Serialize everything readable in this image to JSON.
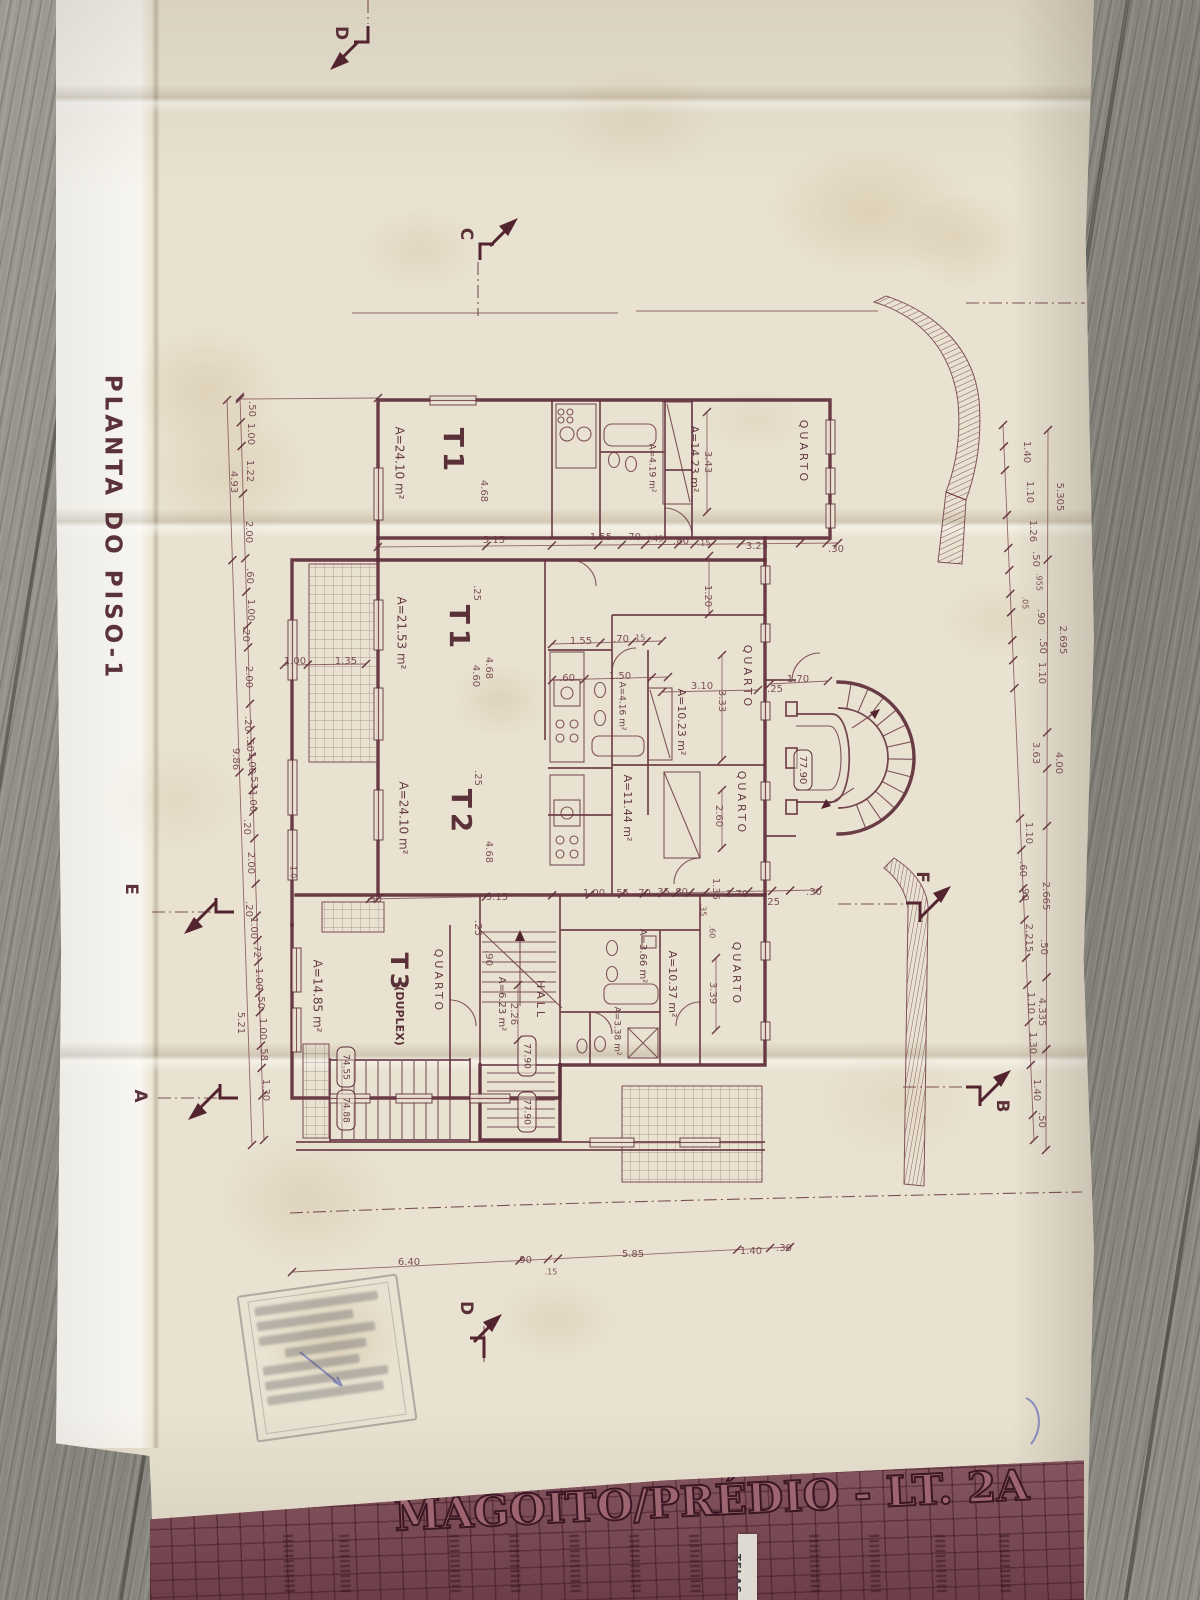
{
  "drawing": {
    "title": "PLANTA DO PISO-1",
    "title_block": {
      "project": "MAGOITO/PRÉDIO - LT. 2A",
      "tape_label": "TELAS"
    },
    "units": [
      {
        "code": "T1",
        "area": "A=24.10 m²"
      },
      {
        "code": "T1",
        "area": "A=21.53 m²"
      },
      {
        "code": "T2",
        "area": "A=24.10 m²"
      },
      {
        "code": "T3 (DUPLEX)",
        "area": "A=14.85 m²"
      }
    ],
    "room_names": [
      "QUARTO",
      "HALL"
    ],
    "levels": [
      "77.90",
      "74.55",
      "74.88"
    ],
    "section_markers": [
      "A",
      "B",
      "C",
      "D",
      "E",
      "F"
    ],
    "labels": [
      {
        "t": "PLANTA DO PISO-1",
        "x": 112,
        "y": 528,
        "r": 1,
        "s": 23,
        "k": "title",
        "ls": 4
      },
      {
        "t": "D",
        "x": 341,
        "y": 33,
        "r": 1,
        "s": 17,
        "k": "section"
      },
      {
        "t": "C",
        "x": 466,
        "y": 234,
        "r": 1,
        "s": 17,
        "k": "section"
      },
      {
        "t": "E",
        "x": 131,
        "y": 889,
        "r": 1,
        "s": 17,
        "k": "section"
      },
      {
        "t": "A",
        "x": 140,
        "y": 1096,
        "r": 1,
        "s": 17,
        "k": "section"
      },
      {
        "t": "F",
        "x": 922,
        "y": 877,
        "r": 1,
        "s": 17,
        "k": "section"
      },
      {
        "t": "B",
        "x": 1002,
        "y": 1106,
        "r": 1,
        "s": 17,
        "k": "section"
      },
      {
        "t": "D",
        "x": 466,
        "y": 1308,
        "r": 1,
        "s": 17,
        "k": "section"
      },
      {
        "t": "T1",
        "x": 452,
        "y": 452,
        "r": 1,
        "s": 28,
        "k": "unit",
        "ls": 5
      },
      {
        "t": "A=24.10 m²",
        "x": 399,
        "y": 463,
        "r": 1,
        "s": 12,
        "k": "area"
      },
      {
        "t": "T1",
        "x": 458,
        "y": 629,
        "r": 1,
        "s": 28,
        "k": "unit",
        "ls": 5
      },
      {
        "t": "A=21.53 m²",
        "x": 401,
        "y": 633,
        "r": 1,
        "s": 12,
        "k": "area"
      },
      {
        "t": "T2",
        "x": 460,
        "y": 813,
        "r": 1,
        "s": 28,
        "k": "unit",
        "ls": 5
      },
      {
        "t": "A=24.10 m²",
        "x": 403,
        "y": 818,
        "r": 1,
        "s": 12,
        "k": "area"
      },
      {
        "t": "T3",
        "x": 398,
        "y": 973,
        "r": 1,
        "s": 24,
        "k": "unit",
        "ls": 4
      },
      {
        "t": "(DUPLEX)",
        "x": 399,
        "y": 1016,
        "r": 1,
        "s": 11,
        "k": "unit"
      },
      {
        "t": "A=14.85 m²",
        "x": 317,
        "y": 996,
        "r": 1,
        "s": 12,
        "k": "area"
      },
      {
        "t": "QUARTO",
        "x": 803,
        "y": 452,
        "r": 1,
        "s": 11,
        "k": "room",
        "ls": 3
      },
      {
        "t": "A=14.23 m²",
        "x": 694,
        "y": 459,
        "r": 1,
        "s": 11,
        "k": "area"
      },
      {
        "t": "A=4.19 m²",
        "x": 652,
        "y": 468,
        "r": 1,
        "s": 9,
        "k": "area"
      },
      {
        "t": "QUARTO",
        "x": 747,
        "y": 677,
        "r": 1,
        "s": 11,
        "k": "room",
        "ls": 3
      },
      {
        "t": "A=10.23 m²",
        "x": 681,
        "y": 722,
        "r": 1,
        "s": 11,
        "k": "area"
      },
      {
        "t": "A=4.16 m²",
        "x": 622,
        "y": 706,
        "r": 1,
        "s": 9,
        "k": "area"
      },
      {
        "t": "QUARTO",
        "x": 741,
        "y": 803,
        "r": 1,
        "s": 11,
        "k": "room",
        "ls": 3
      },
      {
        "t": "A=11.44 m²",
        "x": 627,
        "y": 808,
        "r": 1,
        "s": 11,
        "k": "area"
      },
      {
        "t": "QUARTO",
        "x": 438,
        "y": 981,
        "r": 1,
        "s": 11,
        "k": "room",
        "ls": 3
      },
      {
        "t": "A=6.23 m²",
        "x": 502,
        "y": 1004,
        "r": 1,
        "s": 10,
        "k": "area"
      },
      {
        "t": "HALL",
        "x": 540,
        "y": 1000,
        "r": 1,
        "s": 11,
        "k": "room",
        "ls": 3
      },
      {
        "t": "A=3.66 m²",
        "x": 643,
        "y": 956,
        "r": 1,
        "s": 10,
        "k": "area"
      },
      {
        "t": "A=10.37 m²",
        "x": 672,
        "y": 984,
        "r": 1,
        "s": 11,
        "k": "area"
      },
      {
        "t": "QUARTO",
        "x": 736,
        "y": 974,
        "r": 1,
        "s": 11,
        "k": "room",
        "ls": 3
      },
      {
        "t": "A=3.38 m²",
        "x": 617,
        "y": 1031,
        "r": 1,
        "s": 9,
        "k": "area"
      },
      {
        "t": "77.90",
        "x": 803,
        "y": 770,
        "r": 1,
        "s": 10,
        "k": "level"
      },
      {
        "t": "77.90",
        "x": 527,
        "y": 1056,
        "r": 1,
        "s": 9,
        "k": "level"
      },
      {
        "t": "77.90",
        "x": 527,
        "y": 1112,
        "r": 1,
        "s": 9,
        "k": "level"
      },
      {
        "t": "74.55",
        "x": 346,
        "y": 1067,
        "r": 1,
        "s": 9,
        "k": "level"
      },
      {
        "t": "74.88",
        "x": 346,
        "y": 1110,
        "r": 1,
        "s": 9,
        "k": "level"
      },
      {
        "t": "5.15",
        "x": 494,
        "y": 540
      },
      {
        "t": "1.55",
        "x": 601,
        "y": 537
      },
      {
        "t": ".70",
        "x": 633,
        "y": 537
      },
      {
        "t": "(.45)",
        "x": 657,
        "y": 539,
        "s": 8
      },
      {
        "t": ".80",
        "x": 681,
        "y": 541
      },
      {
        "t": ".15",
        "x": 704,
        "y": 543,
        "s": 8
      },
      {
        "t": "3.25",
        "x": 757,
        "y": 546
      },
      {
        "t": ".30",
        "x": 836,
        "y": 549
      },
      {
        "t": "1.55",
        "x": 581,
        "y": 641
      },
      {
        "t": ".70",
        "x": 621,
        "y": 639
      },
      {
        "t": ".15",
        "x": 639,
        "y": 638,
        "s": 8
      },
      {
        "t": ".60",
        "x": 567,
        "y": 678
      },
      {
        "t": "1.50",
        "x": 620,
        "y": 676
      },
      {
        "t": "3.10",
        "x": 702,
        "y": 686
      },
      {
        "t": ".25",
        "x": 775,
        "y": 689
      },
      {
        "t": "1.70",
        "x": 798,
        "y": 679
      },
      {
        "t": "1.00",
        "x": 295,
        "y": 661
      },
      {
        "t": "1.35",
        "x": 346,
        "y": 661
      },
      {
        "t": ".30",
        "x": 374,
        "y": 899
      },
      {
        "t": "5.15",
        "x": 497,
        "y": 897
      },
      {
        "t": "1.00",
        "x": 594,
        "y": 893
      },
      {
        "t": ".55",
        "x": 621,
        "y": 893
      },
      {
        "t": ".70",
        "x": 643,
        "y": 893
      },
      {
        "t": ".35",
        "x": 662,
        "y": 892
      },
      {
        "t": ".80",
        "x": 680,
        "y": 892
      },
      {
        "t": "1.70",
        "x": 737,
        "y": 894
      },
      {
        "t": ".25",
        "x": 772,
        "y": 902
      },
      {
        "t": ".30",
        "x": 814,
        "y": 892
      },
      {
        "t": "6.40",
        "x": 409,
        "y": 1262
      },
      {
        "t": ".90",
        "x": 524,
        "y": 1260
      },
      {
        "t": ".15",
        "x": 551,
        "y": 1272,
        "s": 8
      },
      {
        "t": "5.85",
        "x": 633,
        "y": 1254
      },
      {
        "t": "1.40",
        "x": 751,
        "y": 1251
      },
      {
        "t": ".30",
        "x": 784,
        "y": 1248
      },
      {
        "t": "4.68",
        "x": 484,
        "y": 491,
        "r": 1
      },
      {
        "t": "3.43",
        "x": 708,
        "y": 462,
        "r": 1
      },
      {
        "t": "1.20",
        "x": 708,
        "y": 596,
        "r": 1
      },
      {
        "t": "4.68",
        "x": 489,
        "y": 668,
        "r": 1
      },
      {
        "t": "4.60",
        "x": 476,
        "y": 676,
        "r": 1
      },
      {
        "t": "3.33",
        "x": 722,
        "y": 701,
        "r": 1
      },
      {
        "t": "2.60",
        "x": 719,
        "y": 816,
        "r": 1
      },
      {
        "t": "4.68",
        "x": 489,
        "y": 852,
        "r": 1
      },
      {
        "t": ".25",
        "x": 477,
        "y": 593,
        "r": 1
      },
      {
        "t": ".25",
        "x": 478,
        "y": 778,
        "r": 1
      },
      {
        "t": "1.35",
        "x": 716,
        "y": 889,
        "r": 1
      },
      {
        "t": ".25",
        "x": 478,
        "y": 928,
        "r": 1
      },
      {
        "t": ".90",
        "x": 489,
        "y": 958,
        "r": 1
      },
      {
        "t": ".35",
        "x": 703,
        "y": 910,
        "r": 1,
        "s": 8
      },
      {
        "t": ".60",
        "x": 712,
        "y": 932,
        "r": 1,
        "s": 8
      },
      {
        "t": "3.39",
        "x": 713,
        "y": 993,
        "r": 1
      },
      {
        "t": "2.26",
        "x": 514,
        "y": 1014,
        "r": 1
      },
      {
        "t": "1.0",
        "x": 293,
        "y": 872,
        "r": 1,
        "s": 8
      },
      {
        "t": ".50",
        "x": 252,
        "y": 409,
        "r": 1
      },
      {
        "t": "1.00",
        "x": 251,
        "y": 434,
        "r": 1
      },
      {
        "t": "1.22",
        "x": 250,
        "y": 471,
        "r": 1
      },
      {
        "t": "4.93",
        "x": 234,
        "y": 482,
        "r": 1
      },
      {
        "t": "2.00",
        "x": 249,
        "y": 532,
        "r": 1
      },
      {
        "t": ".60",
        "x": 250,
        "y": 576,
        "r": 1
      },
      {
        "t": "1.00",
        "x": 251,
        "y": 610,
        "r": 1
      },
      {
        "t": ".20",
        "x": 246,
        "y": 634,
        "r": 1
      },
      {
        "t": "2.00",
        "x": 249,
        "y": 677,
        "r": 1
      },
      {
        "t": ".20",
        "x": 248,
        "y": 724,
        "r": 1
      },
      {
        "t": ".50",
        "x": 250,
        "y": 744,
        "r": 1
      },
      {
        "t": "1.00",
        "x": 252,
        "y": 763,
        "r": 1
      },
      {
        "t": ".53",
        "x": 254,
        "y": 781,
        "r": 1
      },
      {
        "t": "9.86",
        "x": 236,
        "y": 759,
        "r": 1
      },
      {
        "t": "1.00",
        "x": 253,
        "y": 801,
        "r": 1
      },
      {
        "t": ".20",
        "x": 247,
        "y": 827,
        "r": 1
      },
      {
        "t": "2.00",
        "x": 251,
        "y": 863,
        "r": 1
      },
      {
        "t": ".20",
        "x": 249,
        "y": 909,
        "r": 1
      },
      {
        "t": "1.00",
        "x": 254,
        "y": 928,
        "r": 1
      },
      {
        "t": ".72",
        "x": 257,
        "y": 950,
        "r": 1
      },
      {
        "t": "1.00",
        "x": 259,
        "y": 979,
        "r": 1
      },
      {
        "t": ".50",
        "x": 261,
        "y": 1001,
        "r": 1
      },
      {
        "t": "1.00",
        "x": 263,
        "y": 1029,
        "r": 1
      },
      {
        "t": ".58",
        "x": 264,
        "y": 1053,
        "r": 1
      },
      {
        "t": "1.30",
        "x": 266,
        "y": 1090,
        "r": 1
      },
      {
        "t": "5.21",
        "x": 241,
        "y": 1023,
        "r": 1
      },
      {
        "t": "1.40",
        "x": 1027,
        "y": 452,
        "r": 1
      },
      {
        "t": "1.10",
        "x": 1030,
        "y": 492,
        "r": 1
      },
      {
        "t": "5.305",
        "x": 1060,
        "y": 497,
        "r": 1
      },
      {
        "t": "1.26",
        "x": 1033,
        "y": 531,
        "r": 1
      },
      {
        "t": ".50",
        "x": 1036,
        "y": 559,
        "r": 1
      },
      {
        "t": ".955",
        "x": 1039,
        "y": 582,
        "r": 1,
        "s": 8
      },
      {
        "t": ".05",
        "x": 1025,
        "y": 603,
        "r": 1,
        "s": 8
      },
      {
        "t": ".90",
        "x": 1041,
        "y": 617,
        "r": 1
      },
      {
        "t": ".50",
        "x": 1043,
        "y": 646,
        "r": 1
      },
      {
        "t": "2.695",
        "x": 1063,
        "y": 640,
        "r": 1
      },
      {
        "t": "1.10",
        "x": 1042,
        "y": 673,
        "r": 1
      },
      {
        "t": "3.63",
        "x": 1036,
        "y": 753,
        "r": 1
      },
      {
        "t": "4.00",
        "x": 1059,
        "y": 763,
        "r": 1
      },
      {
        "t": "1.10",
        "x": 1029,
        "y": 833,
        "r": 1
      },
      {
        "t": ".60",
        "x": 1023,
        "y": 869,
        "r": 1
      },
      {
        "t": ".90",
        "x": 1025,
        "y": 893,
        "r": 1
      },
      {
        "t": "2.665",
        "x": 1046,
        "y": 896,
        "r": 1
      },
      {
        "t": "2.215",
        "x": 1029,
        "y": 938,
        "r": 1
      },
      {
        "t": ".50",
        "x": 1044,
        "y": 947,
        "r": 1
      },
      {
        "t": "1.10",
        "x": 1031,
        "y": 1003,
        "r": 1
      },
      {
        "t": "4.335",
        "x": 1042,
        "y": 1012,
        "r": 1
      },
      {
        "t": "1.30",
        "x": 1033,
        "y": 1043,
        "r": 1
      },
      {
        "t": "1.40",
        "x": 1037,
        "y": 1090,
        "r": 1
      },
      {
        "t": ".50",
        "x": 1042,
        "y": 1120,
        "r": 1
      }
    ]
  }
}
